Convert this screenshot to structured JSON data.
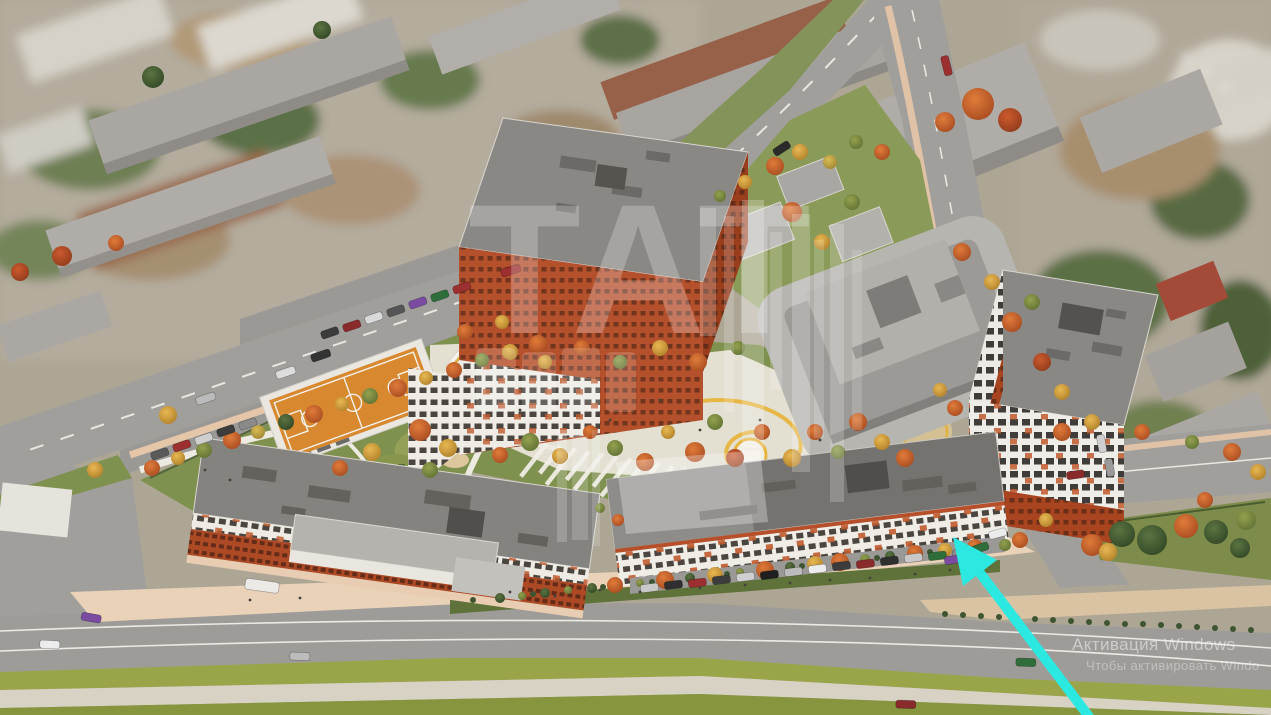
{
  "overlay": {
    "activation": {
      "line1": "Активация Windows",
      "line2": "Чтобы активировать Windo"
    }
  },
  "watermark": {
    "text": "ТАТ"
  },
  "annotation": {
    "arrow_color": "#2BE9E1"
  },
  "palette": {
    "facade_orange": "#B5502C",
    "facade_white": "#F0EDE7",
    "roof_gray": "#87857F",
    "road_gray": "#A19F9C",
    "grass_green": "#7F914F",
    "court_orange": "#D8892F",
    "path_yellow": "#E7B43E",
    "plaza_pink": "#EAD2B8",
    "arrow_cyan": "#2BE9E1"
  }
}
